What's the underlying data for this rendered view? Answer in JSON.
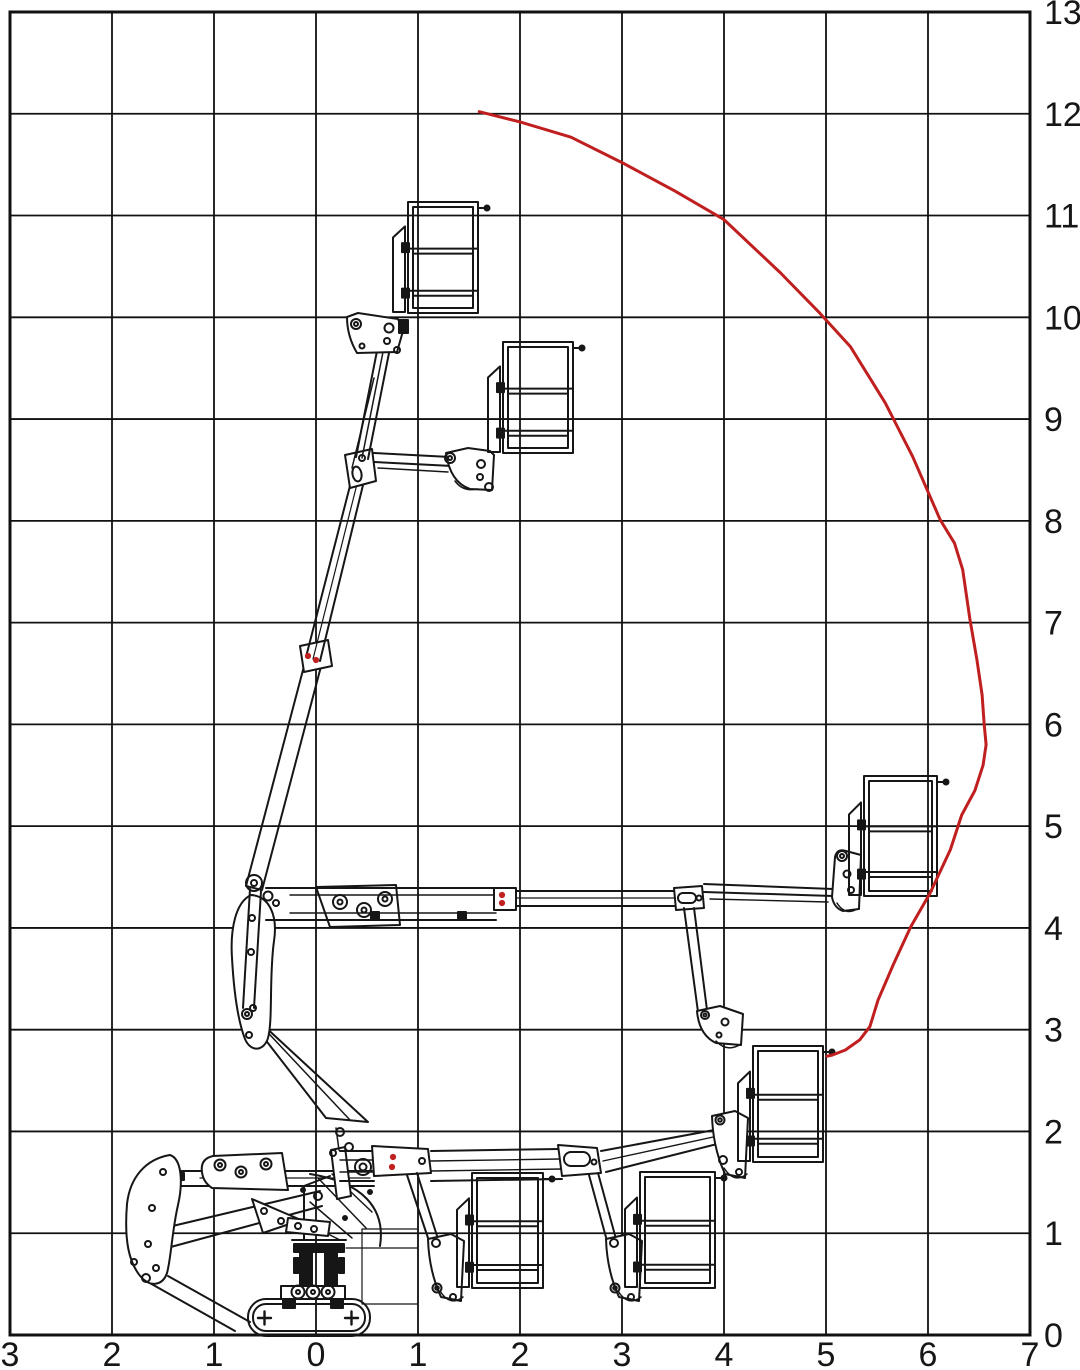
{
  "figure": {
    "type": "aerial-platform-working-envelope-diagram",
    "background": "#ffffff",
    "units": "m"
  },
  "axes": {
    "x": {
      "values": [
        -3,
        -2,
        -1,
        0,
        1,
        2,
        3,
        4,
        5,
        6,
        7
      ],
      "labels": [
        "3",
        "2",
        "1",
        "0",
        "1",
        "2",
        "3",
        "4",
        "5",
        "6",
        "7"
      ]
    },
    "y": {
      "values": [
        0,
        1,
        2,
        3,
        4,
        5,
        6,
        7,
        8,
        9,
        10,
        11,
        12,
        13
      ],
      "labels": [
        "0",
        "1",
        "2",
        "3",
        "4",
        "5",
        "6",
        "7",
        "8",
        "9",
        "10",
        "11",
        "12",
        "13"
      ]
    }
  },
  "grid": {
    "color": "#111111",
    "line_width": 1.8,
    "border_width": 3
  },
  "envelope": {
    "color": "#c01f1f",
    "line_width": 3,
    "points": [
      [
        1.6,
        12.02
      ],
      [
        2.0,
        11.92
      ],
      [
        2.5,
        11.77
      ],
      [
        3.0,
        11.52
      ],
      [
        3.52,
        11.24
      ],
      [
        4.0,
        10.96
      ],
      [
        4.55,
        10.44
      ],
      [
        4.94,
        10.04
      ],
      [
        5.24,
        9.71
      ],
      [
        5.58,
        9.16
      ],
      [
        5.85,
        8.63
      ],
      [
        6.12,
        8.01
      ],
      [
        6.26,
        7.78
      ],
      [
        6.34,
        7.52
      ],
      [
        6.41,
        7.04
      ],
      [
        6.48,
        6.63
      ],
      [
        6.53,
        6.29
      ],
      [
        6.55,
        6.01
      ],
      [
        6.57,
        5.8
      ],
      [
        6.54,
        5.6
      ],
      [
        6.46,
        5.35
      ],
      [
        6.33,
        5.11
      ],
      [
        6.22,
        4.77
      ],
      [
        6.02,
        4.34
      ],
      [
        5.83,
        4.01
      ],
      [
        5.66,
        3.64
      ],
      [
        5.51,
        3.29
      ],
      [
        5.43,
        3.03
      ],
      [
        5.33,
        2.9
      ],
      [
        5.19,
        2.8
      ],
      [
        5.06,
        2.75
      ],
      [
        5.01,
        2.74
      ]
    ]
  },
  "machine": {
    "line_color": "#161616",
    "baskets_px": [
      {
        "x": 408,
        "y": 202,
        "w": 70,
        "h": 111
      },
      {
        "x": 503,
        "y": 342,
        "w": 70,
        "h": 111
      },
      {
        "x": 864,
        "y": 776,
        "w": 73,
        "h": 120
      },
      {
        "x": 753,
        "y": 1046,
        "w": 70,
        "h": 116
      },
      {
        "x": 472,
        "y": 1173,
        "w": 71,
        "h": 115
      },
      {
        "x": 640,
        "y": 1172,
        "w": 75,
        "h": 116
      }
    ],
    "red_marks": {
      "color": "#c02020",
      "dots_px": [
        [
          308,
          656
        ],
        [
          316,
          660
        ],
        [
          502,
          895
        ],
        [
          502,
          903
        ],
        [
          393,
          1157
        ],
        [
          392,
          1167
        ]
      ]
    }
  }
}
